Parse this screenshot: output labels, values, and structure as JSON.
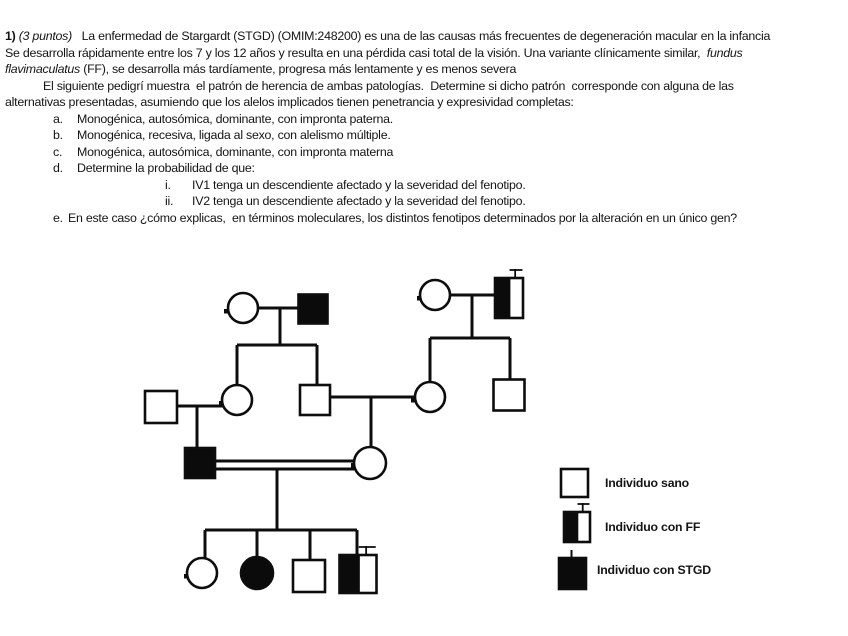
{
  "document": {
    "lines": [
      {
        "ind": 5,
        "seg": [
          {
            "t": "1) ",
            "st": "b"
          },
          {
            "t": "(3 puntos)",
            "st": "i"
          },
          {
            "t": "   La enfermedad de Stargardt (STGD) (OMIM:248200) es una de las causas más frecuentes de degeneración macular en la infancia"
          }
        ]
      },
      {
        "ind": 5,
        "seg": [
          {
            "t": "Se desarrolla rápidamente entre los 7 y los 12 años y resulta en una pérdida casi total de la visión. Una variante clínicamente similar,  "
          },
          {
            "t": "fundus",
            "st": "i"
          }
        ]
      },
      {
        "ind": 5,
        "seg": [
          {
            "t": "flavimaculatus",
            "st": "i"
          },
          {
            "t": " (FF), se desarrolla más tardíamente, progresa más lentamente y es menos severa"
          }
        ]
      },
      {
        "ind": 43,
        "seg": [
          {
            "t": "El siguiente pedigrí muestra  el patrón de herencia de ambas patologías.  Determine si dicho patrón  corresponde con alguna de las"
          }
        ]
      },
      {
        "ind": 5,
        "seg": [
          {
            "t": "alternativas presentadas, asumiendo que los alelos implicados tienen penetrancia y expresividad completas:"
          }
        ]
      },
      {
        "ind": 53,
        "marker": "a.",
        "mw": 24,
        "seg": [
          {
            "t": "Monogénica, autosómica, dominante, con impronta paterna."
          }
        ]
      },
      {
        "ind": 53,
        "marker": "b.",
        "mw": 24,
        "seg": [
          {
            "t": "Monogénica, recesiva, ligada al sexo, con alelismo múltiple."
          }
        ]
      },
      {
        "ind": 53,
        "marker": "c.",
        "mw": 24,
        "seg": [
          {
            "t": "Monogénica, autosómica, dominante, con impronta materna"
          }
        ]
      },
      {
        "ind": 53,
        "marker": "d.",
        "mw": 24,
        "seg": [
          {
            "t": "Determine la probabilidad de que:"
          }
        ]
      },
      {
        "ind": 165,
        "marker": "i.",
        "mw": 27,
        "seg": [
          {
            "t": "IV1 tenga un descendiente afectado y la severidad del fenotipo."
          }
        ]
      },
      {
        "ind": 165,
        "marker": "ii.",
        "mw": 27,
        "seg": [
          {
            "t": "IV2 tenga un descendiente afectado y la severidad del fenotipo."
          }
        ]
      },
      {
        "ind": 53,
        "marker": "e.",
        "mw": 15,
        "seg": [
          {
            "t": "En este caso ¿cómo explicas,  en términos moleculares, los distintos fenotipos determinados por la alteración en un único gen?"
          }
        ]
      }
    ]
  },
  "pedigree": {
    "colors": {
      "ink": "#0d0d0d",
      "fill_affected": "#0b0b0b",
      "fill_healthy": "#ffffff"
    },
    "individuals": [
      {
        "id": "I-1",
        "sex": "F",
        "status": "sano",
        "cx": 243,
        "cy": 308,
        "r": 15
      },
      {
        "id": "I-2",
        "sex": "M",
        "status": "stgd",
        "cx": 313,
        "cy": 309,
        "w": 29,
        "h": 29
      },
      {
        "id": "I-3",
        "sex": "F",
        "status": "sano",
        "cx": 435,
        "cy": 295,
        "r": 15
      },
      {
        "id": "I-4",
        "sex": "M",
        "status": "ff",
        "cx": 509,
        "cy": 298,
        "w": 28,
        "h": 40
      },
      {
        "id": "II-1",
        "sex": "M",
        "status": "sano",
        "cx": 161,
        "cy": 407,
        "w": 32,
        "h": 32
      },
      {
        "id": "II-2",
        "sex": "F",
        "status": "sano",
        "cx": 237,
        "cy": 400,
        "r": 15
      },
      {
        "id": "II-3",
        "sex": "M",
        "status": "sano",
        "cx": 315,
        "cy": 400,
        "w": 30,
        "h": 30
      },
      {
        "id": "II-4",
        "sex": "F",
        "status": "sano",
        "cx": 430,
        "cy": 397,
        "r": 15
      },
      {
        "id": "II-5",
        "sex": "M",
        "status": "sano",
        "cx": 509,
        "cy": 395,
        "w": 31,
        "h": 31
      },
      {
        "id": "III-1",
        "sex": "M",
        "status": "stgd",
        "cx": 200,
        "cy": 463,
        "w": 30,
        "h": 30
      },
      {
        "id": "III-2",
        "sex": "F",
        "status": "sano",
        "cx": 370,
        "cy": 463,
        "r": 16
      },
      {
        "id": "IV-1",
        "sex": "F",
        "status": "sano",
        "cx": 202,
        "cy": 573,
        "r": 15
      },
      {
        "id": "IV-2",
        "sex": "F",
        "status": "stgd",
        "cx": 257,
        "cy": 573,
        "r": 16
      },
      {
        "id": "IV-3",
        "sex": "M",
        "status": "sano",
        "cx": 309,
        "cy": 576,
        "w": 32,
        "h": 32
      },
      {
        "id": "IV-4",
        "sex": "M",
        "status": "ff",
        "cx": 358,
        "cy": 574,
        "w": 37,
        "h": 38
      }
    ],
    "relation_lines": [
      [
        258,
        308,
        299,
        308
      ],
      [
        280,
        308,
        280,
        345
      ],
      [
        237,
        345,
        317,
        345
      ],
      [
        237,
        345,
        237,
        386
      ],
      [
        317,
        345,
        317,
        386
      ],
      [
        450,
        295,
        495,
        295
      ],
      [
        472,
        295,
        472,
        338
      ],
      [
        430,
        338,
        510,
        338
      ],
      [
        430,
        338,
        430,
        383
      ],
      [
        510,
        338,
        510,
        380
      ],
      [
        177,
        406,
        223,
        406
      ],
      [
        197,
        406,
        197,
        449
      ],
      [
        330,
        397,
        416,
        397
      ],
      [
        371,
        397,
        371,
        448
      ],
      [
        215,
        461,
        355,
        461
      ],
      [
        215,
        469,
        355,
        469
      ],
      [
        277,
        469,
        277,
        530
      ],
      [
        205,
        530,
        357,
        530
      ],
      [
        205,
        530,
        205,
        559
      ],
      [
        257,
        530,
        257,
        558
      ],
      [
        310,
        530,
        310,
        561
      ],
      [
        357,
        530,
        357,
        556
      ]
    ],
    "ticks": [
      [
        226,
        311
      ],
      [
        419,
        298
      ],
      [
        221,
        403
      ],
      [
        413,
        400
      ],
      [
        353,
        465
      ],
      [
        186,
        576
      ]
    ]
  },
  "legend": {
    "items": [
      {
        "type": "sano",
        "label": "Individuo sano",
        "sym": {
          "x": 561,
          "y": 469,
          "w": 27,
          "h": 28
        },
        "lx": 605,
        "ly": 476
      },
      {
        "type": "ff",
        "label": "Individuo con FF",
        "sym": {
          "x": 564,
          "y": 512,
          "w": 26,
          "h": 30
        },
        "lx": 605,
        "ly": 520
      },
      {
        "type": "stgd",
        "label": "Individuo con STGD",
        "sym": {
          "x": 559,
          "y": 558,
          "w": 27,
          "h": 31
        },
        "lx": 597,
        "ly": 563
      }
    ]
  }
}
